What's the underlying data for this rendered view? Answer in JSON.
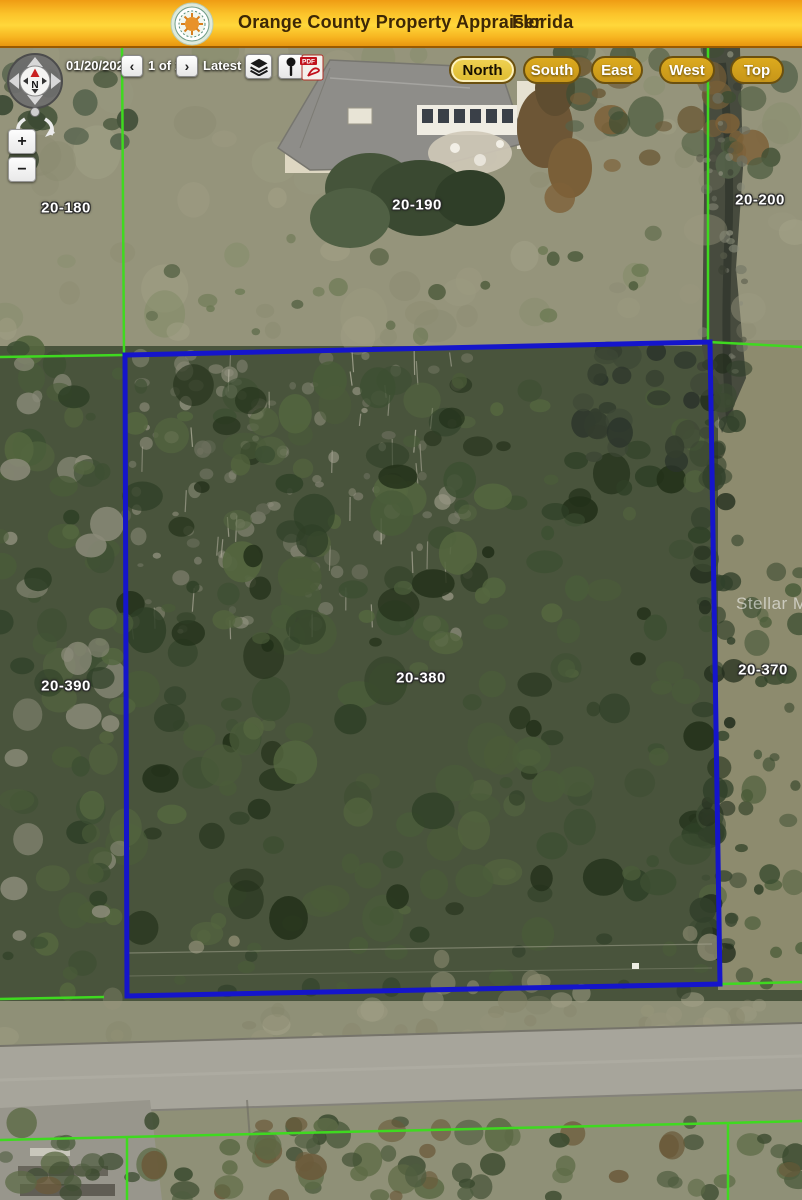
{
  "header": {
    "title": "Orange County Property Appraiser",
    "region": "Florida",
    "logo": "county-seal-icon"
  },
  "toolbar": {
    "date": "01/20/2025",
    "prev": "‹",
    "pager": "1 of 11",
    "next": "›",
    "latest": "Latest",
    "latest_caret": "▼",
    "layers_icon": "layers-icon",
    "marker_icon": "pin-icon",
    "pdf_icon": "pdf-icon",
    "pdf_label": "PDF"
  },
  "view_buttons": [
    {
      "label": "North",
      "active": true
    },
    {
      "label": "South",
      "active": false
    },
    {
      "label": "East",
      "active": false
    },
    {
      "label": "West",
      "active": false
    },
    {
      "label": "Top",
      "active": false
    }
  ],
  "compass": {
    "north": "N"
  },
  "zoom": {
    "in": "+",
    "out": "−"
  },
  "map": {
    "watermark": "Stellar MLS",
    "selected_parcel": "20-380",
    "parcels": [
      {
        "label": "20-180"
      },
      {
        "label": "20-190"
      },
      {
        "label": "20-200"
      },
      {
        "label": "20-390"
      },
      {
        "label": "20-380"
      },
      {
        "label": "20-370"
      }
    ],
    "colors": {
      "selected_boundary": "#1515cb",
      "lot_line": "#3fd920",
      "header_gold": "#ffd22e"
    }
  }
}
